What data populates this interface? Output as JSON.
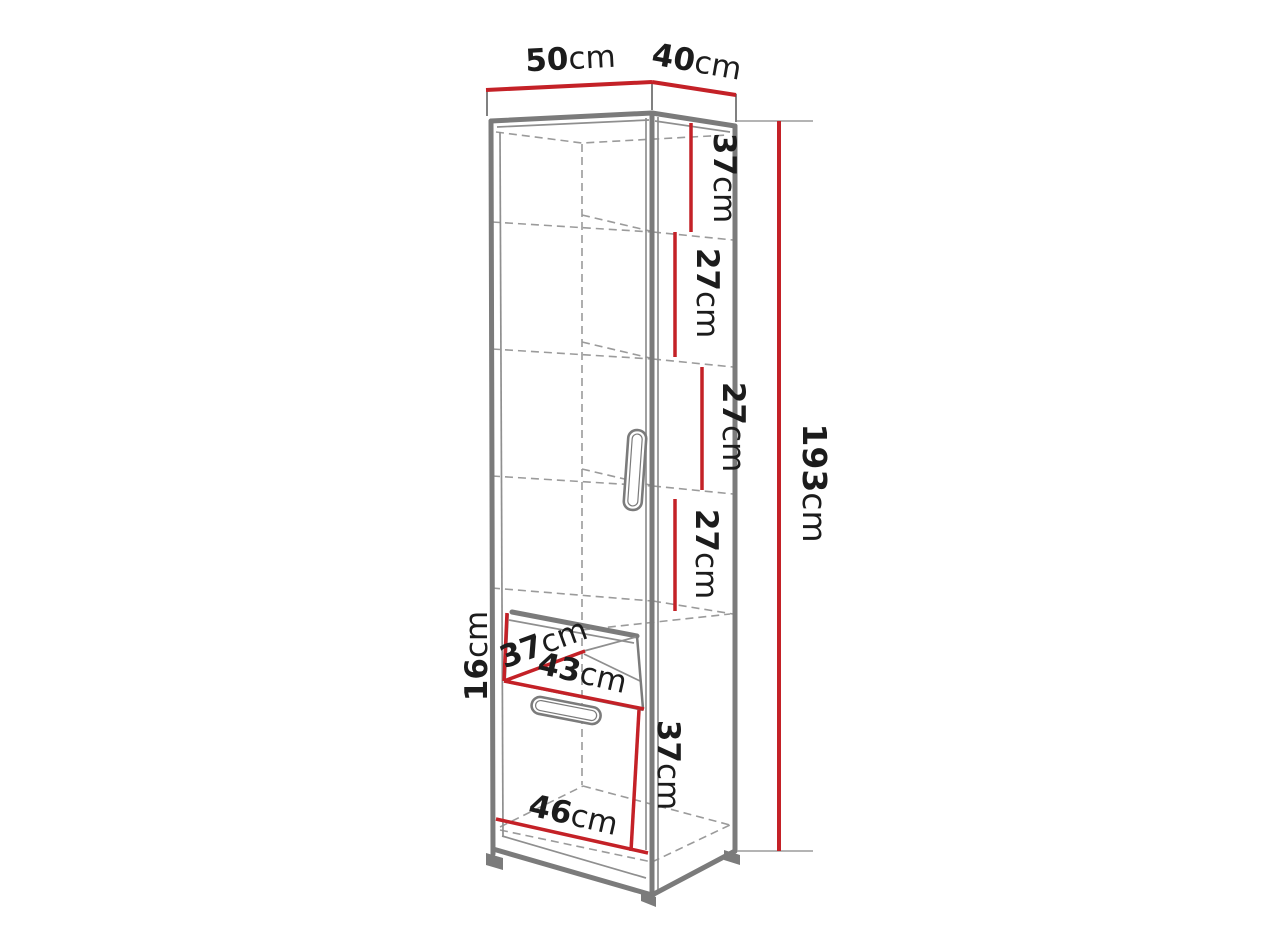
{
  "diagram": {
    "type": "furniture-dimension-drawing",
    "subject": "tall single-door wardrobe cabinet with drawer, shown in perspective with red dimension lines",
    "unit": "cm",
    "colors": {
      "dimension_line": "#c42127",
      "outline_gray": "#7b7b7b",
      "hidden_line_gray": "#9b9b9b",
      "label_text": "#1c1c1c",
      "background": "#ffffff"
    },
    "dimensions": {
      "width_top": {
        "value": "50",
        "unit": "cm"
      },
      "depth_top": {
        "value": "40",
        "unit": "cm"
      },
      "shelf_section_1": {
        "value": "37",
        "unit": "cm"
      },
      "shelf_section_2": {
        "value": "27",
        "unit": "cm"
      },
      "shelf_section_3": {
        "value": "27",
        "unit": "cm"
      },
      "shelf_section_4": {
        "value": "27",
        "unit": "cm"
      },
      "total_height": {
        "value": "193",
        "unit": "cm"
      },
      "drawer_height": {
        "value": "16",
        "unit": "cm"
      },
      "drawer_depth": {
        "value": "37",
        "unit": "cm"
      },
      "drawer_width": {
        "value": "43",
        "unit": "cm"
      },
      "bottom_section": {
        "value": "37",
        "unit": "cm"
      },
      "bottom_width": {
        "value": "46",
        "unit": "cm"
      }
    }
  }
}
